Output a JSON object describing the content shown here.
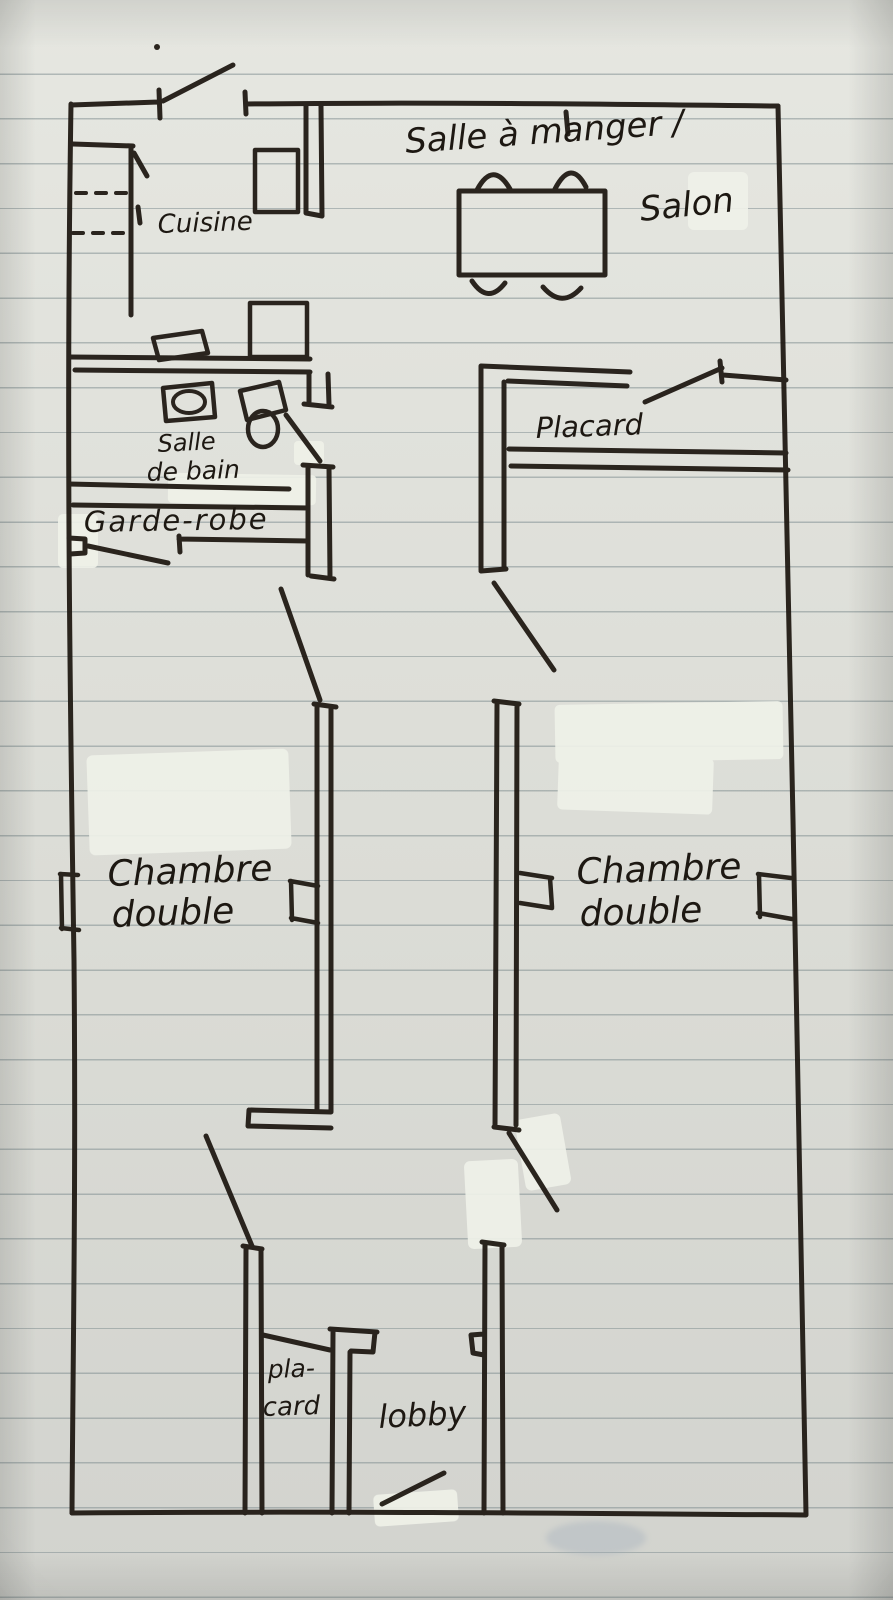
{
  "document": {
    "type": "hand-drawn floor plan sketch",
    "medium": "black marker on lined notebook paper",
    "language": "French"
  },
  "labels": {
    "dining_line1": "Salle à manger /",
    "dining_line2": "Salon",
    "kitchen": "Cuisine",
    "bathroom_line1": "Salle",
    "bathroom_line2": "de bain",
    "wardrobe": "Garde-robe",
    "closet": "Placard",
    "bedroom_left_line1": "Chambre",
    "bedroom_left_line2": "double",
    "bedroom_right_line1": "Chambre",
    "bedroom_right_line2": "double",
    "closet_bottom_line1": "pla-",
    "closet_bottom_line2": "card",
    "lobby": "lobby"
  },
  "rooms": [
    "Salle à manger / Salon",
    "Cuisine",
    "Salle de bain",
    "Garde-robe",
    "Placard",
    "Chambre double",
    "Chambre double",
    "pla-card",
    "lobby"
  ],
  "furniture_icons": [
    "dining-table",
    "chair",
    "refrigerator",
    "stove",
    "kitchen-sink",
    "bathroom-sink",
    "toilet"
  ],
  "colors": {
    "ink": "#201a14",
    "paper": "#dfe0da",
    "ruled_line": "#7a898c",
    "white_out": "#eff1e9"
  }
}
